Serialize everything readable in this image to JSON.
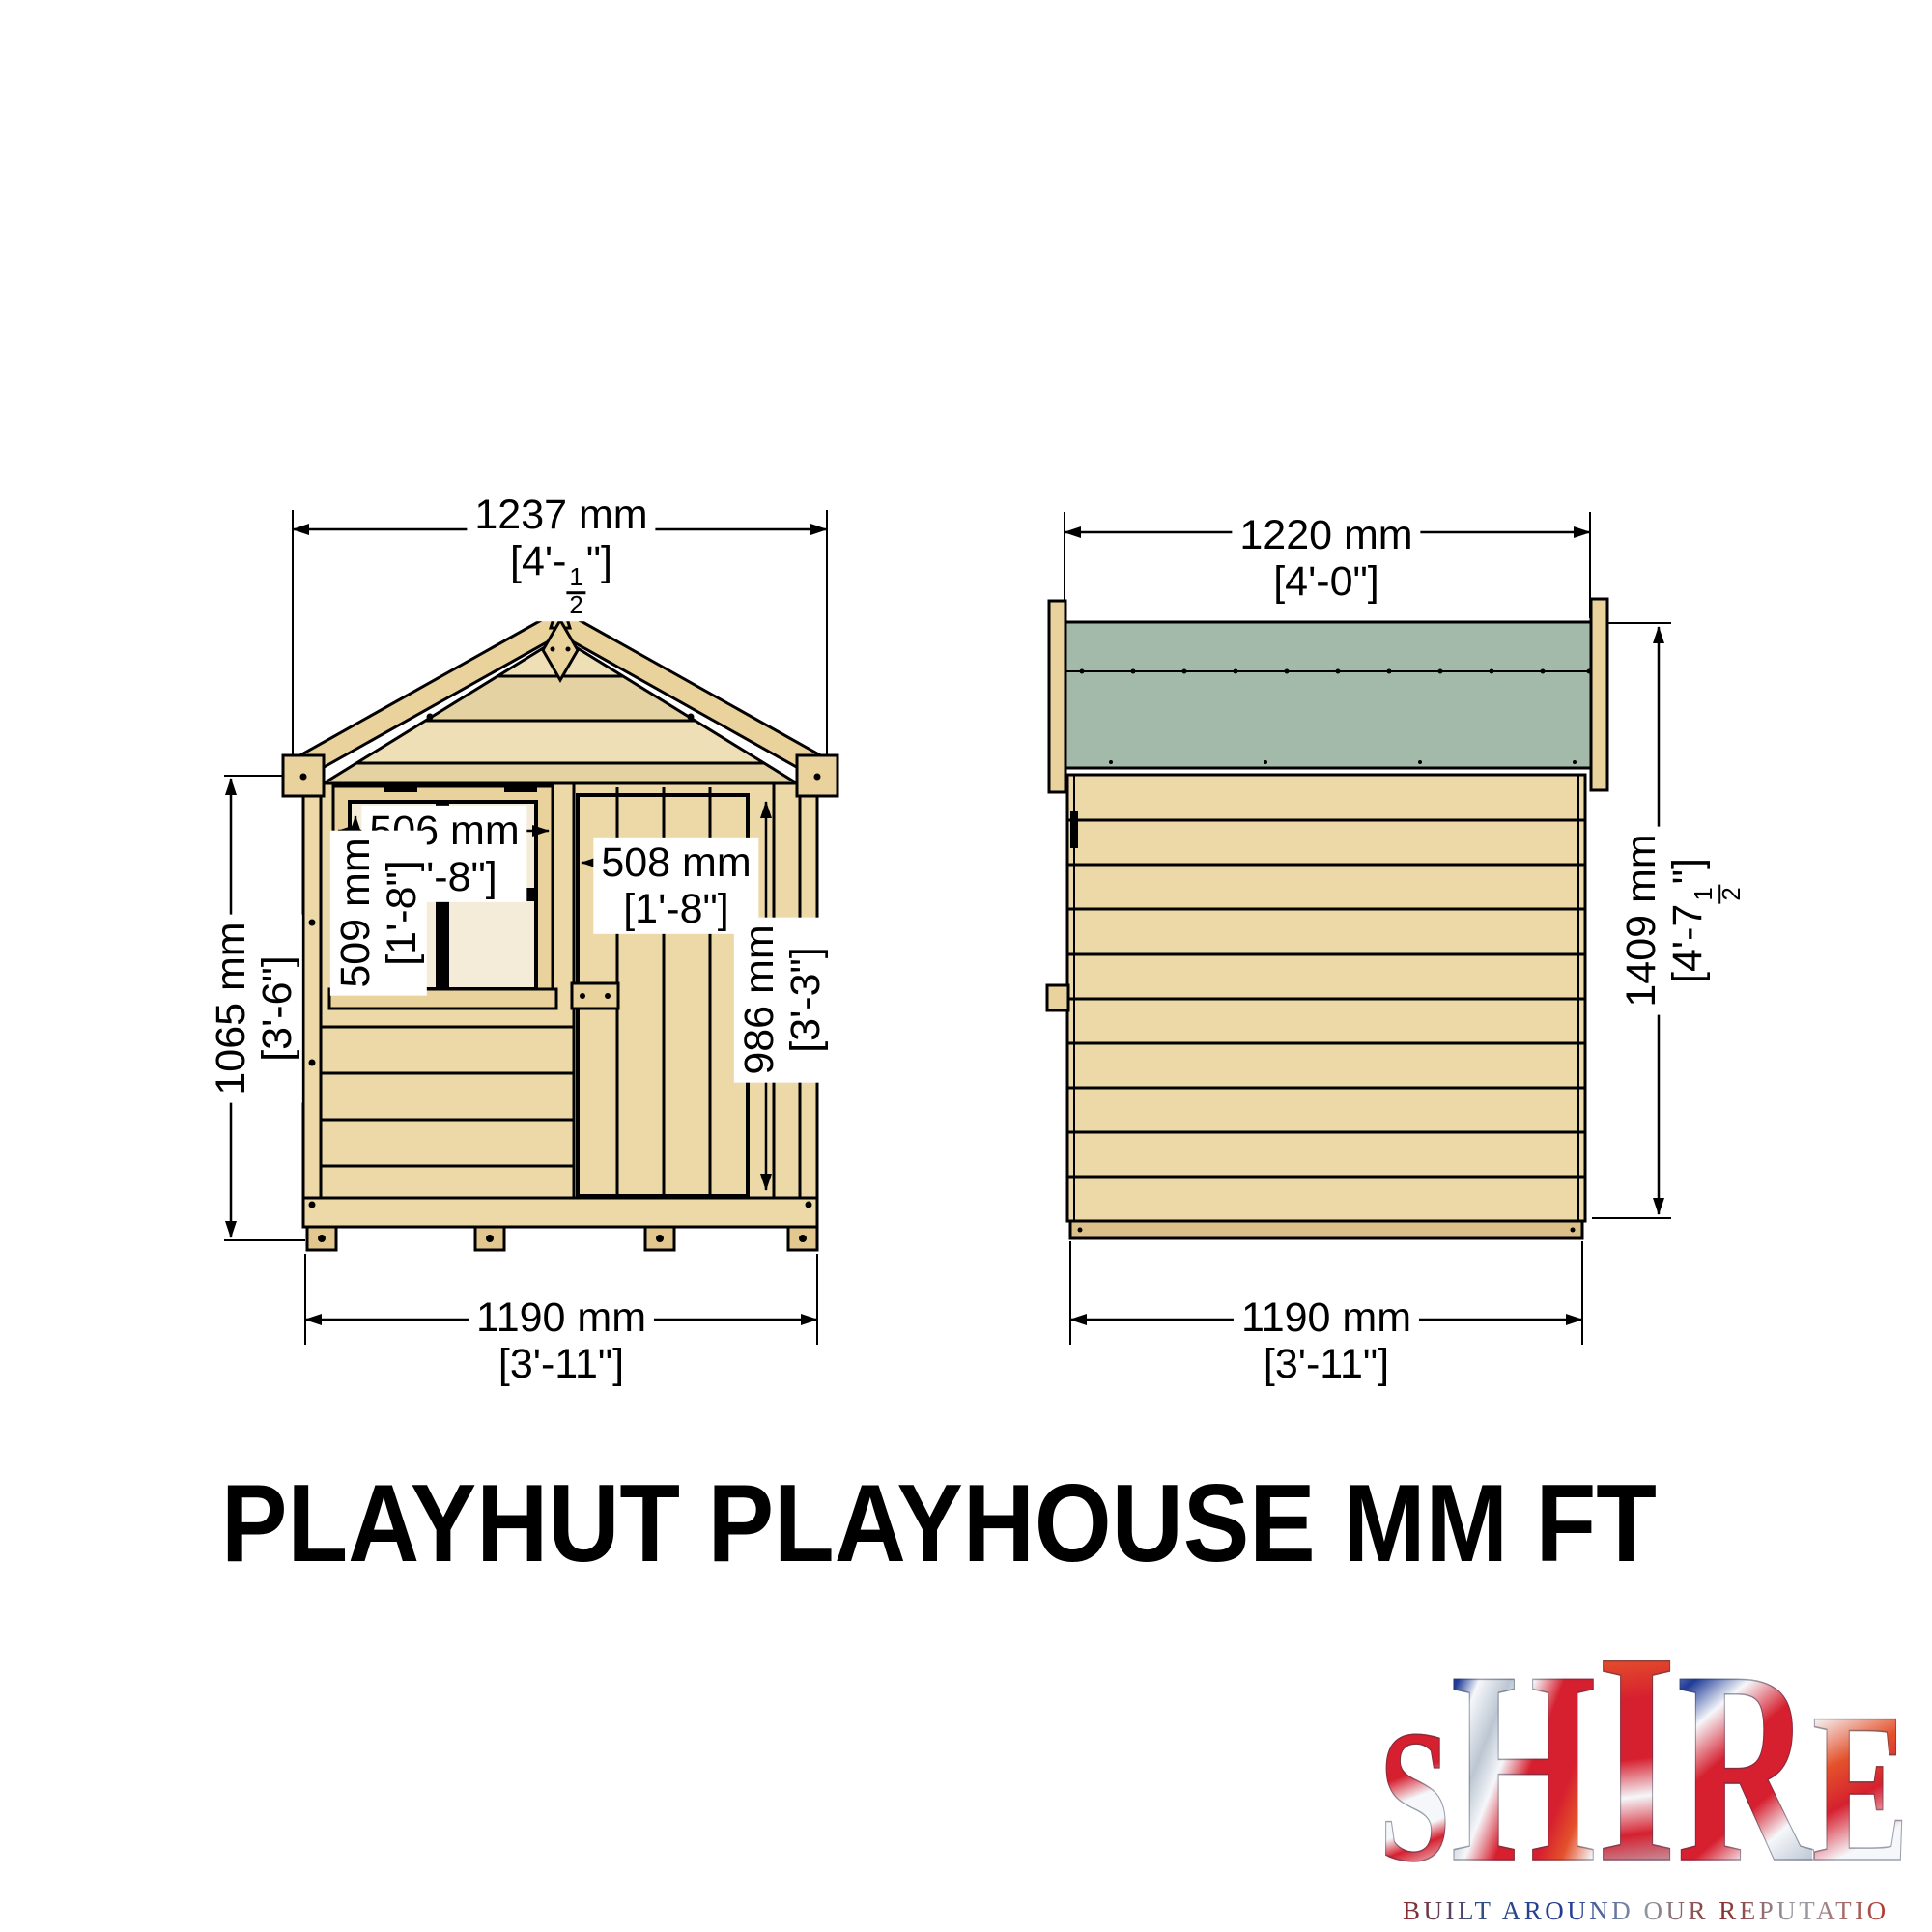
{
  "title": "PLAYHUT PLAYHOUSE MM FT",
  "views": {
    "front": {
      "top_width_mm": "1237 mm",
      "top_width_ft_pre": "[4'-",
      "top_width_frac_num": "1",
      "top_width_frac_den": "2",
      "top_width_ft_post": "\"]",
      "height_mm": "1065 mm",
      "height_ft": "[3'-6\"]",
      "base_width_mm": "1190 mm",
      "base_width_ft": "[3'-11\"]",
      "window_width_mm": "506 mm",
      "window_width_ft": "[1'-8\"]",
      "window_height_mm": "509 mm",
      "window_height_ft": "[1'-8\"]",
      "door_width_mm": "508 mm",
      "door_width_ft": "[1'-8\"]",
      "door_height_mm": "986 mm",
      "door_height_ft": "[3'-3\"]"
    },
    "side": {
      "top_width_mm": "1220 mm",
      "top_width_ft": "[4'-0\"]",
      "height_mm": "1409 mm",
      "height_ft_pre": "[4'-7",
      "height_frac_num": "1",
      "height_frac_den": "2",
      "height_ft_post": "\"]",
      "base_width_mm": "1190 mm",
      "base_width_ft": "[3'-11\"]"
    }
  },
  "logo": {
    "letters": [
      "S",
      "H",
      "I",
      "R",
      "E"
    ],
    "tagline": "BUILT AROUND OUR REPUTATION"
  },
  "colors": {
    "wood": "#edd9a8",
    "wood2": "#e9d29b",
    "wood_dark": "#e2c88e",
    "gable": "#eedfb6",
    "gable_dark": "#e5d2a2",
    "pane": "#f4ecd8",
    "green": "#a3baab",
    "skid": "#dcc08a",
    "lg_red": "#d6202f",
    "lg_blue": "#1f3b97",
    "lg_white": "#f5f7fa",
    "lg_silver": "#bcc6d2",
    "lg_orange": "#e4512b"
  }
}
